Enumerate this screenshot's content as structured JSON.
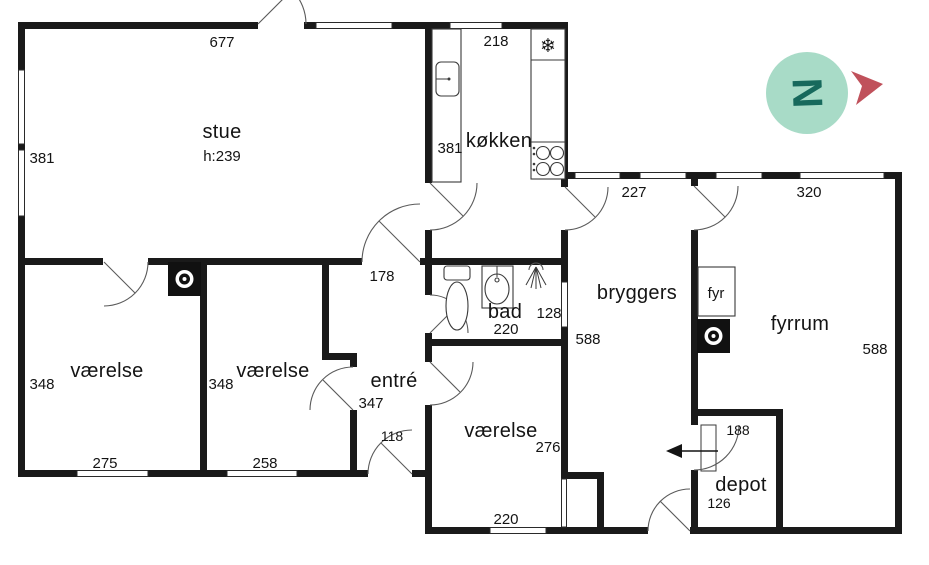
{
  "rooms": {
    "stue": {
      "label": "stue",
      "ceiling": "h:239",
      "dim_top": "677",
      "dim_left": "381"
    },
    "kokken": {
      "label": "køkken",
      "dim_top": "218",
      "dim_left": "381"
    },
    "bryggers": {
      "label": "bryggers",
      "dim_top": "227",
      "dim_side": "588"
    },
    "fyrrum": {
      "label": "fyrrum",
      "dim_top": "320",
      "dim_side": "588",
      "fyr_label": "fyr"
    },
    "bad": {
      "label": "bad",
      "dim_width": "220",
      "dim_depth": "128"
    },
    "entre": {
      "label": "entré",
      "dim_length": "347",
      "dim_width": "118",
      "dim_top": "178"
    },
    "vaerelse_1": {
      "label": "værelse",
      "dim_side": "348",
      "dim_bottom": "275"
    },
    "vaerelse_2": {
      "label": "værelse",
      "dim_side": "348",
      "dim_bottom": "258"
    },
    "vaerelse_3": {
      "label": "værelse",
      "dim_side": "276",
      "dim_bottom": "220"
    },
    "depot": {
      "label": "depot",
      "dim_top": "188",
      "dim_side": "126"
    }
  },
  "icons": {
    "freezer_glyph": "❄"
  },
  "compass": {
    "letter": "N"
  },
  "colors": {
    "wall": "#1a1a1a",
    "compass_circle": "#a8dbc7",
    "compass_letter": "#17695c",
    "compass_arrow": "#c0515b"
  }
}
